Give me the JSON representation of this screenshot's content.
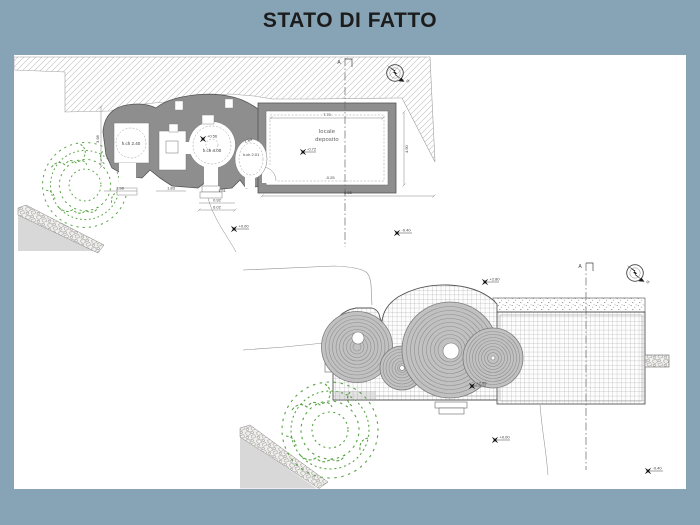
{
  "title": "STATO DI FATTO",
  "colors": {
    "background": "#87a4b6",
    "panel": "#ffffff",
    "wall": "#8e8e8e",
    "tree": "#58a344",
    "ink": "#1c1c1c"
  },
  "plan_top": {
    "section_label": "A",
    "north_label": "N",
    "room_left_label": "h.ch 2.40",
    "room_center_elev": "+0.56",
    "room_center_label": "h.ch 4.00",
    "room_right_dim": "1.84",
    "room_right_label": "h.ch 2.01",
    "deposito_line1": "locale",
    "deposito_line2": "deposito",
    "deposito_elev": "-0.72",
    "dim_top": "7.70",
    "dim_right": "4.90",
    "dim_inner_bottom": "-0.25",
    "dim_bottom": "6.65",
    "dim_left_v": "3.98",
    "dim_a": "1.98",
    "dim_b": "1.83",
    "dim_c": "0.92",
    "dim_d": "6.02",
    "dim_e": "1.51",
    "marker_ground": "+0.00",
    "marker_right": "-0.40"
  },
  "plan_bottom": {
    "section_label": "A",
    "north_label": "N",
    "marker_top": "+2.80",
    "marker_mid": "+2.85",
    "marker_ground": "+0.00",
    "marker_right": "-0.40"
  }
}
